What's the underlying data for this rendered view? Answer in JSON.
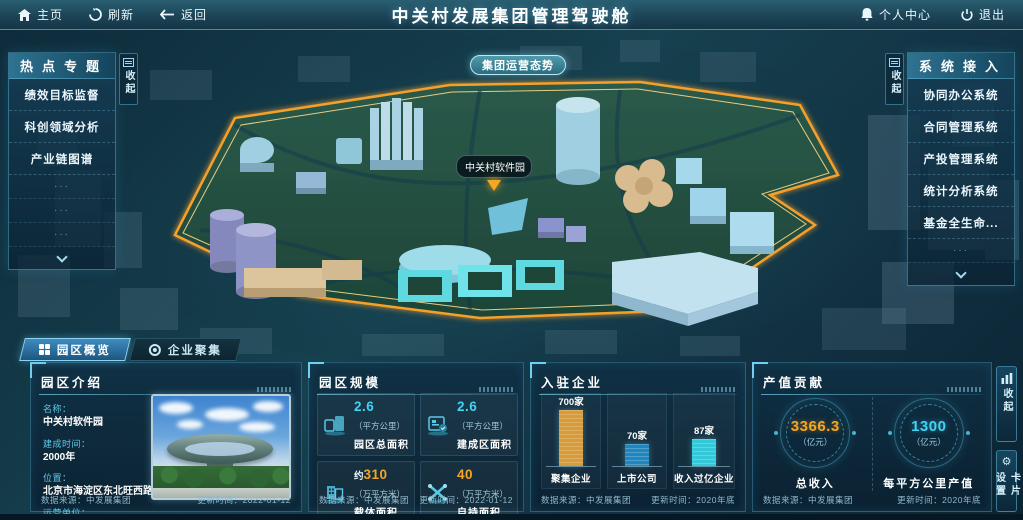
{
  "topbar": {
    "home": "主页",
    "refresh": "刷新",
    "back": "返回",
    "title": "中关村发展集团管理驾驶舱",
    "personal_center": "个人中心",
    "logout": "退出"
  },
  "map": {
    "overview_button": "集团运营态势",
    "marker_label": "中关村软件园"
  },
  "left_panel": {
    "title": "热点专题",
    "collapse_label": "收起",
    "items": [
      "绩效目标监督",
      "科创领域分析",
      "产业链图谱"
    ],
    "placeholder_dots": "···"
  },
  "right_panel": {
    "title": "系统接入",
    "collapse_label": "收起",
    "items": [
      "协同办公系统",
      "合同管理系统",
      "产投管理系统",
      "统计分析系统",
      "基金全生命..."
    ],
    "placeholder_dots": "···"
  },
  "tabs": [
    {
      "label": "园区概览",
      "active": true
    },
    {
      "label": "企业聚集",
      "active": false
    }
  ],
  "panels": {
    "intro": {
      "title": "园区介绍",
      "fields": [
        {
          "label": "名称：",
          "value": "中关村软件园"
        },
        {
          "label": "建成时间：",
          "value": "2000年"
        },
        {
          "label": "位置：",
          "value": "北京市海淀区东北旺西路8号"
        },
        {
          "label": "运营单位：",
          "value": "北京中关村软件园发展有限公司"
        }
      ],
      "source": "数据来源：中发展集团",
      "updated": "更新时间：2022-01-12"
    },
    "scale": {
      "title": "园区规模",
      "cards": [
        {
          "prefix": "",
          "value": "2.6",
          "unit": "（平方公里）",
          "label": "园区总面积"
        },
        {
          "prefix": "",
          "value": "2.6",
          "unit": "（平方公里）",
          "label": "建成区面积"
        },
        {
          "prefix": "约",
          "value": "310",
          "unit": "（万平方米）",
          "label": "载体面积"
        },
        {
          "prefix": "",
          "value": "40",
          "unit": "（万平方米）",
          "label": "自持面积"
        }
      ],
      "source": "数据来源：中发展集团",
      "updated": "更新时间：2022-01-12"
    },
    "enterprises": {
      "title": "入驻企业",
      "source": "数据来源：中发展集团",
      "updated": "更新时间：2020年底"
    },
    "output": {
      "title": "产值贡献",
      "gauges": [
        {
          "value": "3366.3",
          "unit": "（亿元）",
          "label": "总收入"
        },
        {
          "value": "1300",
          "unit": "（亿元）",
          "label": "每平方公里产值"
        }
      ],
      "source": "数据来源：中发展集团",
      "updated": "更新时间：2020年底"
    }
  },
  "side_buttons": [
    {
      "label": "收起",
      "icon": "bar-chart-icon"
    },
    {
      "label": "卡片设置",
      "icon": "gear-icon"
    }
  ],
  "chart_data": {
    "type": "bar",
    "title": "入驻企业",
    "categories": [
      "聚集企业",
      "上市公司",
      "收入过亿企业"
    ],
    "values": [
      700,
      70,
      87
    ],
    "value_labels": [
      "700家",
      "70家",
      "87家"
    ],
    "bar_colors": [
      "#d89b3a",
      "#1f86c0",
      "#35c8d8"
    ],
    "display_heights_px": [
      64,
      22,
      27
    ],
    "xlabel": "",
    "ylabel": "",
    "legend": "none",
    "grid": false
  },
  "colors": {
    "accent_cyan": "#3fd4f5",
    "accent_orange": "#f5a623",
    "park_glow": "#f5a02b",
    "panel_border": "#56aacd",
    "topbar_bg": "#1b4254"
  }
}
